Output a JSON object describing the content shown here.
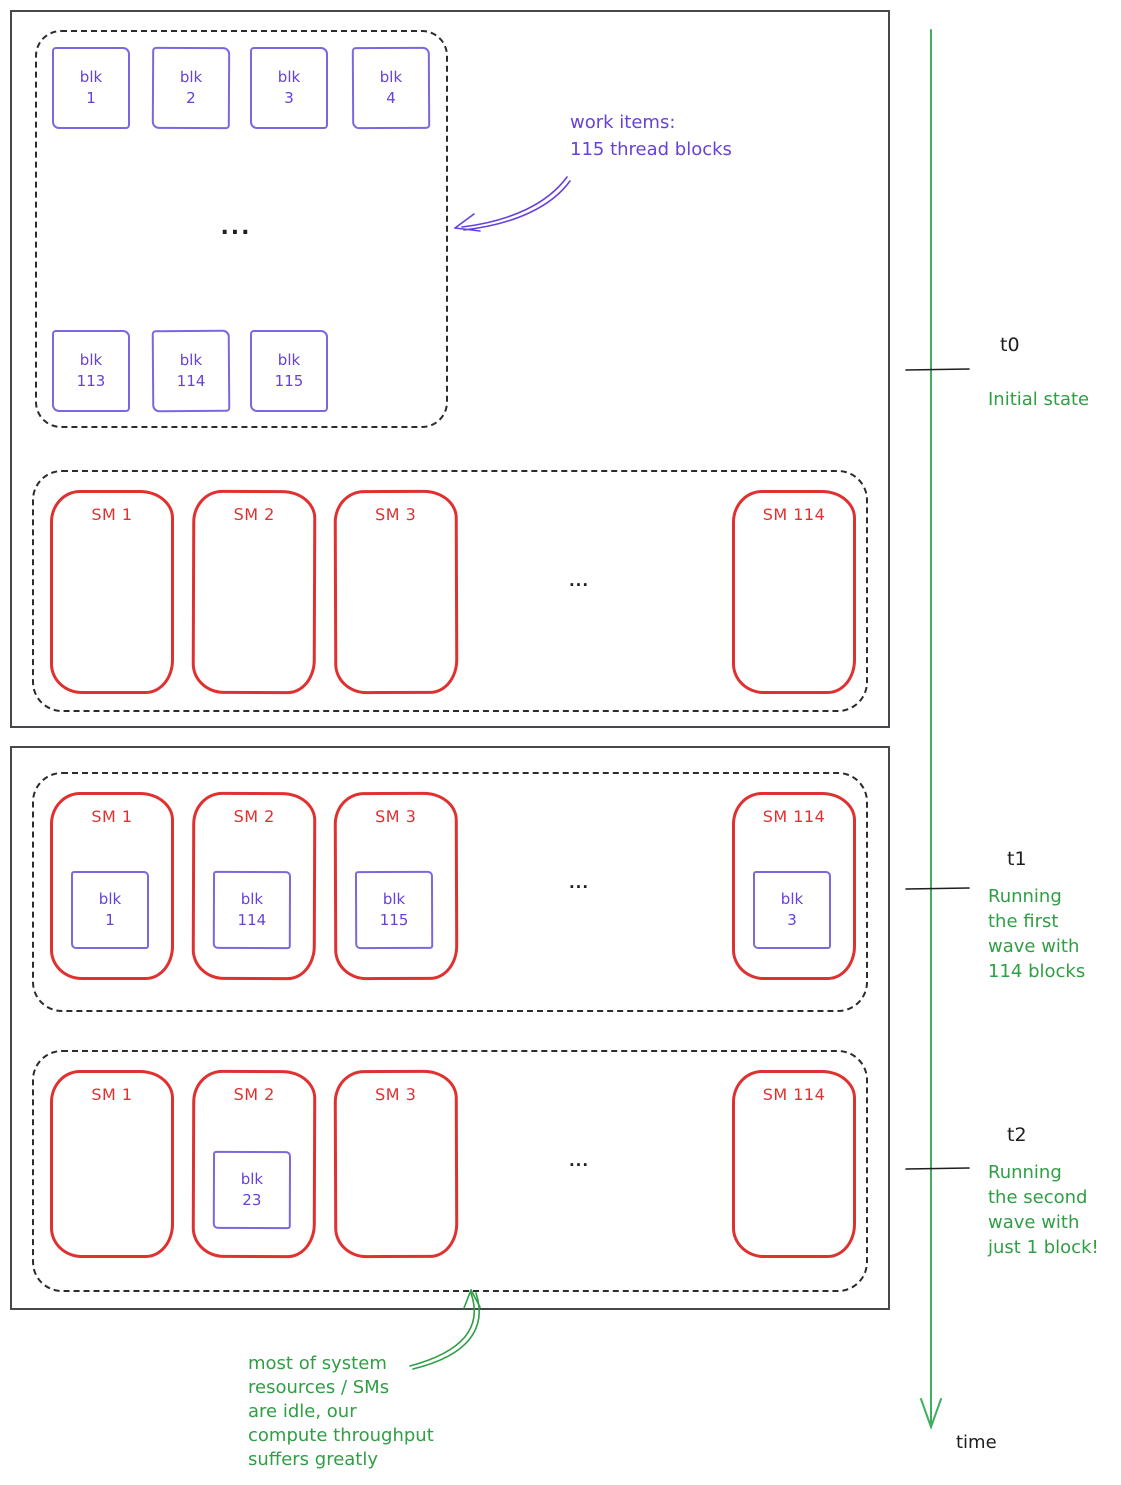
{
  "colors": {
    "violet": "#6741d9",
    "violet_border": "#7b68e0",
    "red": "#e03131",
    "green": "#2f9e44",
    "timeline_green": "#3faf5f",
    "ink": "#1e1e1e"
  },
  "work_items": {
    "top_blocks": [
      {
        "l1": "blk",
        "l2": "1"
      },
      {
        "l1": "blk",
        "l2": "2"
      },
      {
        "l1": "blk",
        "l2": "3"
      },
      {
        "l1": "blk",
        "l2": "4"
      }
    ],
    "bottom_blocks": [
      {
        "l1": "blk",
        "l2": "113"
      },
      {
        "l1": "blk",
        "l2": "114"
      },
      {
        "l1": "blk",
        "l2": "115"
      }
    ],
    "ellipsis": "...",
    "annotation": {
      "line1": "work items:",
      "line2": "115 thread blocks"
    }
  },
  "rows": {
    "t0": {
      "ellipsis": "...",
      "sms": [
        {
          "label": "SM 1"
        },
        {
          "label": "SM 2"
        },
        {
          "label": "SM 3"
        },
        {
          "label": "SM 114"
        }
      ]
    },
    "t1": {
      "ellipsis": "...",
      "sms": [
        {
          "label": "SM 1",
          "blk_l1": "blk",
          "blk_l2": "1"
        },
        {
          "label": "SM 2",
          "blk_l1": "blk",
          "blk_l2": "114"
        },
        {
          "label": "SM 3",
          "blk_l1": "blk",
          "blk_l2": "115"
        },
        {
          "label": "SM 114",
          "blk_l1": "blk",
          "blk_l2": "3"
        }
      ]
    },
    "t2": {
      "ellipsis": "...",
      "sms": [
        {
          "label": "SM 1"
        },
        {
          "label": "SM 2",
          "blk_l1": "blk",
          "blk_l2": "23"
        },
        {
          "label": "SM 3"
        },
        {
          "label": "SM 114"
        }
      ]
    }
  },
  "timeline": {
    "t0": {
      "label": "t0",
      "caption": "Initial state"
    },
    "t1": {
      "label": "t1",
      "caption_l1": "Running",
      "caption_l2": "the first",
      "caption_l3": "wave with",
      "caption_l4": "114 blocks"
    },
    "t2": {
      "label": "t2",
      "caption_l1": "Running",
      "caption_l2": "the second",
      "caption_l3": "wave with",
      "caption_l4": "just 1 block!"
    },
    "axis_label": "time"
  },
  "bottom_annotation": {
    "l1": "most of system",
    "l2": "resources / SMs",
    "l3": "are idle, our",
    "l4": "compute throughput",
    "l5": "suffers greatly"
  }
}
